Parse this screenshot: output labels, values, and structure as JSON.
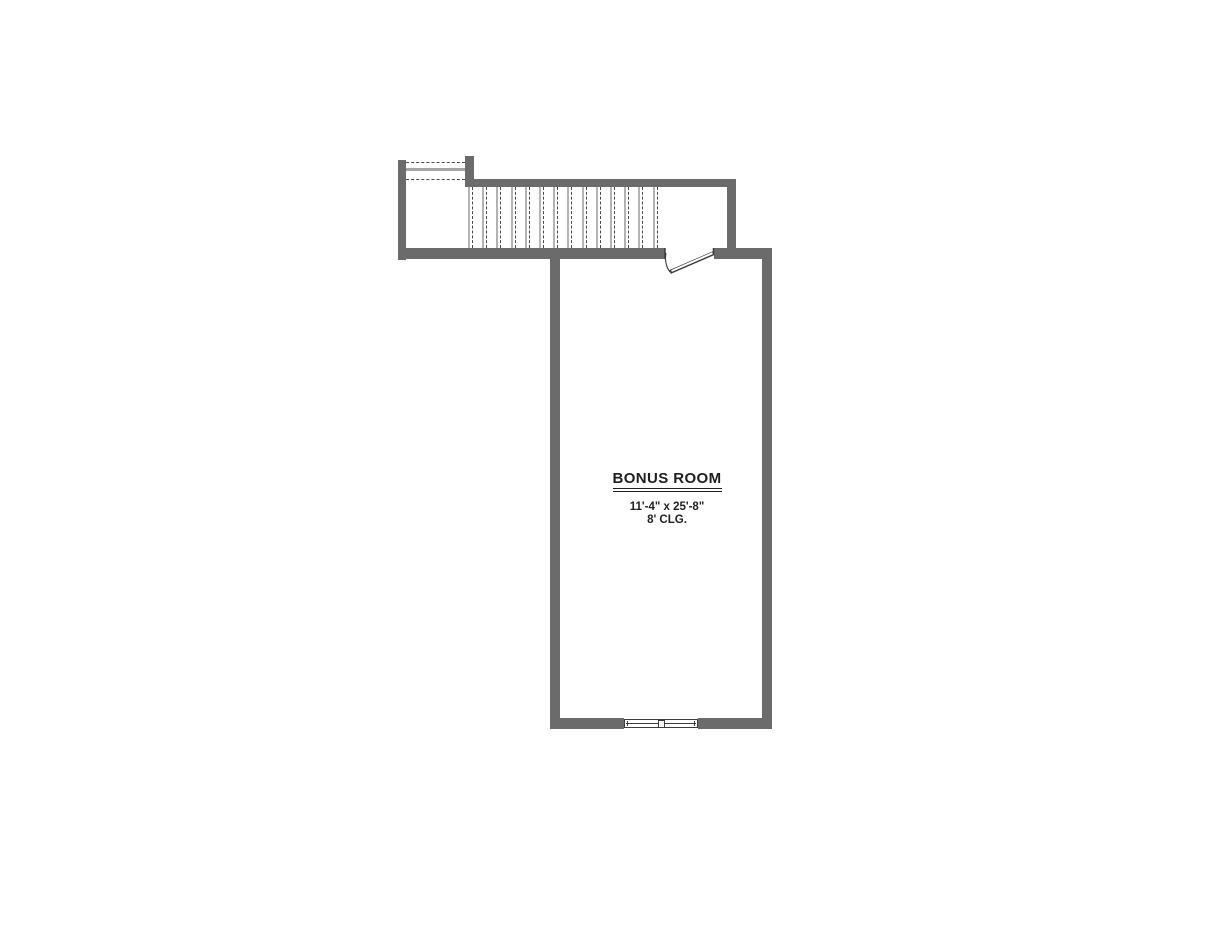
{
  "plan": {
    "room": {
      "name": "BONUS ROOM",
      "dimensions": "11'-4\" x 25'-8\"",
      "ceiling": "8' CLG."
    },
    "stairs": {
      "tread_count": 14,
      "tread_spacing_px": 14.2
    },
    "colors": {
      "wall": "#6b6b6b",
      "dash": "#4a4a4a",
      "tread": "#b3b3b3",
      "landing": "#a5a5a5",
      "line": "#3c3c3c",
      "text": "#1f1f1f"
    }
  }
}
